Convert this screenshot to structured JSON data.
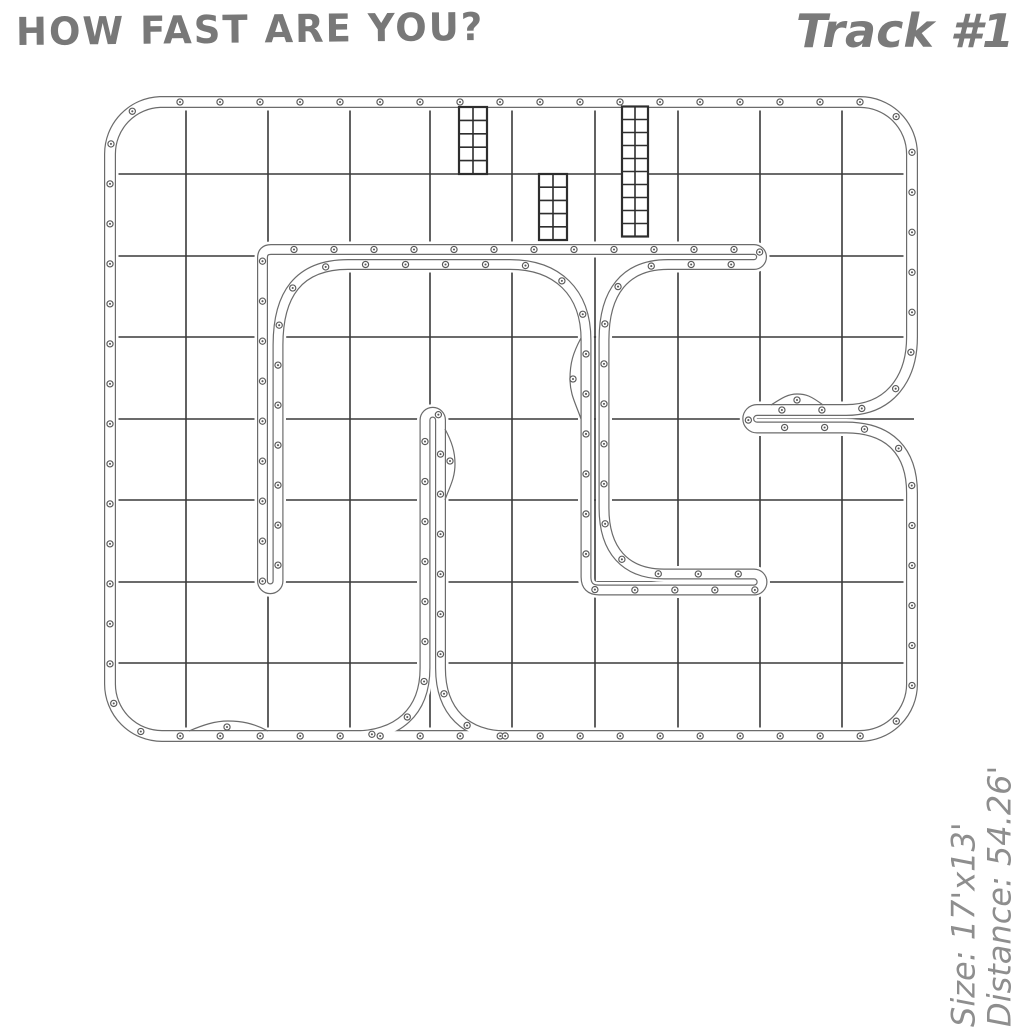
{
  "header": {
    "title": "HOW FAST ARE YOU?",
    "track_label": "Track #1"
  },
  "side_info": {
    "size_label": "Size: 17'x13'",
    "distance_label": "Distance: 54.26'"
  },
  "diagram": {
    "colors": {
      "grid_line": "#3a3a3a",
      "wall_line": "#6b6b6b",
      "wall_fill": "#ffffff",
      "rivet": "#5a5a5a",
      "ladder_line": "#2e2e2e"
    },
    "grid": {
      "cols_x": [
        186,
        268,
        350,
        430,
        512,
        595,
        678,
        760,
        842
      ],
      "rows_y": [
        174,
        256,
        337,
        419,
        500,
        582,
        663
      ],
      "v_y0": 100,
      "v_y1": 738,
      "h_x0": 108,
      "h_x1": 914
    },
    "rivet_spacing": 40,
    "walls": [
      {
        "name": "outer-border",
        "width": 12,
        "d": "M 160 102 L 860 102 A 52 52 0 0 1 912 154 L 912 337 C 912 378 890 410 846 410 L 757 410 A 8.75 8.75 0 0 0 757 427.5 L 846 427.5 C 890 427.5 912 452 912 493 L 912 684 A 52 52 0 0 1 860 736 L 162 736 A 52 52 0 0 1 110 684 L 110 154 A 52 52 0 0 1 160 102 Z"
      },
      {
        "name": "inner-serpentine-wall",
        "width": 11,
        "d": "M 754 249.5 L 271 249.5 Q 262.5 249.5 262.5 258 L 262.5 581 A 7.75 7.75 0 0 0 278 581 L 278 345 C 278 295 298 264.5 348 264.5 L 510 264.5 C 557 264.5 586 292 586 340 L 586 577 Q 586 590 599 590 L 754 590 A 8 8 0 0 0 754 574 L 664 574 C 625 574 604 550 604 508 L 604 340 C 604 292 625 264.5 668 264.5 L 754 264.5 A 7.5 7.5 0 0 0 754 249.5 Z"
      },
      {
        "name": "center-divider-wall",
        "width": 11,
        "d": "M 352 736 C 398 736 425 712 425 668 L 425 420 A 7.75 7.75 0 0 1 440.5 420 L 440.5 668 C 440.5 712 466 736 508 736"
      }
    ],
    "bulges": [
      {
        "name": "serpentine-left-wiggle",
        "d": "M 581 338 C 573 353 570 363 570 379 C 570 395 576 404 581 419",
        "rivet": [
          573,
          379
        ]
      },
      {
        "name": "divider-right-bulge",
        "d": "M 445 429 C 452 442 455 452 455 464 C 455 479 449 488 445 500",
        "rivet": [
          450,
          461
        ]
      },
      {
        "name": "bottom-border-bump",
        "d": "M 268 731 C 253 723 241 721 228 721 C 215 721 203 725 189 731",
        "rivet": [
          227,
          727
        ]
      },
      {
        "name": "notch-rail-bump",
        "d": "M 823 405 C 811 396 806 394 797 394 C 788 394 782 398 771 405",
        "rivet": [
          797,
          400
        ]
      }
    ],
    "ladders": [
      {
        "name": "ladder-section-1",
        "x": 459,
        "y": 107,
        "w": 28,
        "h": 67,
        "rows": 5,
        "cols": 2
      },
      {
        "name": "ladder-section-2",
        "x": 539,
        "y": 174,
        "w": 28,
        "h": 66,
        "rows": 5,
        "cols": 2
      },
      {
        "name": "ladder-section-3",
        "x": 622,
        "y": 106.5,
        "w": 26,
        "h": 130,
        "rows": 10,
        "cols": 2
      }
    ]
  }
}
